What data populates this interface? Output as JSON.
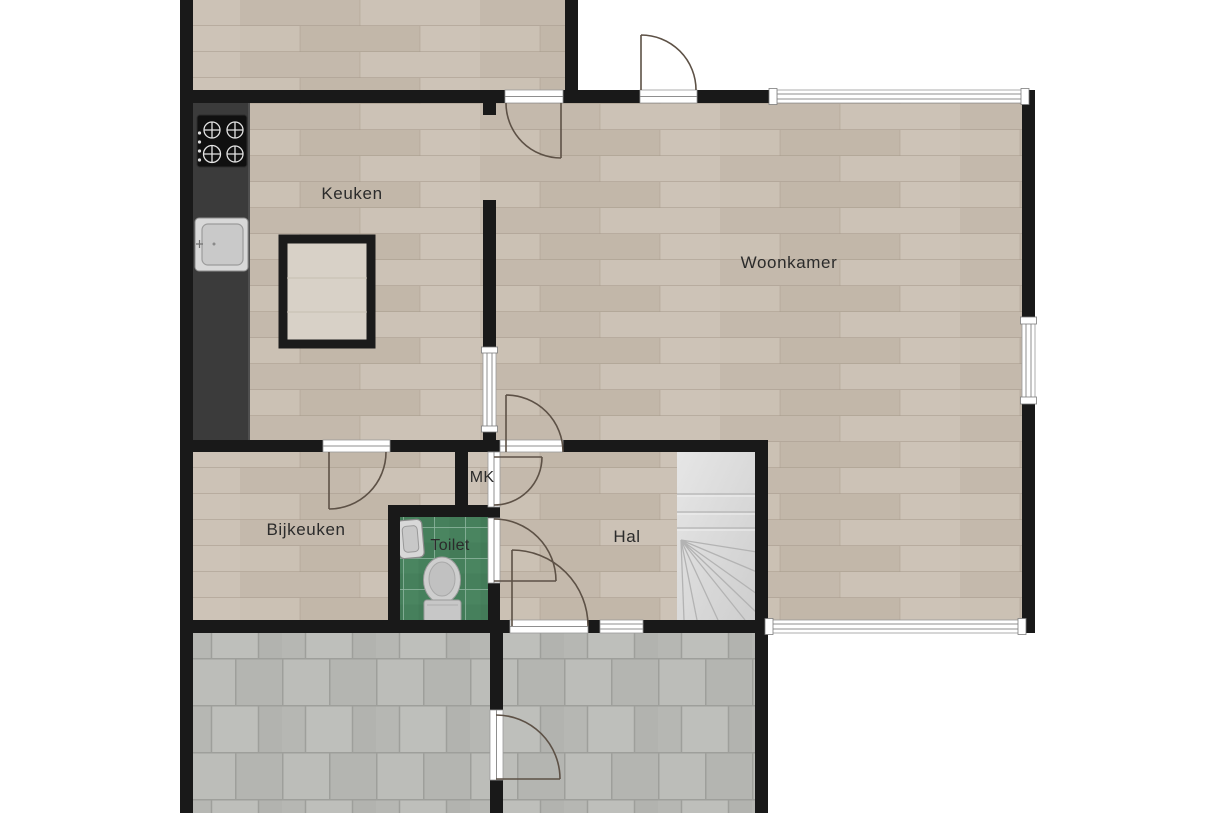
{
  "plan": {
    "title_hidden": "",
    "rooms": [
      {
        "id": "keuken",
        "label": "Keuken"
      },
      {
        "id": "woonkamer",
        "label": "Woonkamer"
      },
      {
        "id": "bijkeuken",
        "label": "Bijkeuken"
      },
      {
        "id": "mk",
        "label": "MK"
      },
      {
        "id": "toilet",
        "label": "Toilet"
      },
      {
        "id": "hal",
        "label": "Hal"
      }
    ],
    "fixtures": [
      "stove-icon",
      "sink-icon",
      "kitchen-island",
      "washbasin-icon",
      "toilet-icon",
      "staircase",
      "door-swing",
      "window",
      "wall"
    ],
    "colors": {
      "wall": "#191919",
      "wood_floor": "#c9bfb3",
      "gray_tile": "#b8b9b5",
      "gray_grout": "#9e9f9b",
      "toilet_tile": "#46805c",
      "counter": "#3b3b3b",
      "stairs": "#dcdcdc",
      "door_arc": "#5d5146",
      "background": "#ffffff"
    }
  }
}
